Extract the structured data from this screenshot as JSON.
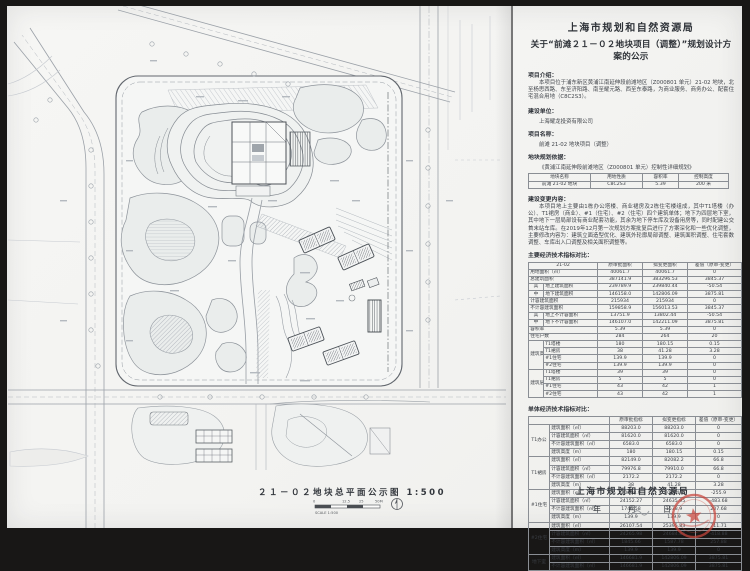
{
  "header": {
    "title1": "上海市规划和自然资源局",
    "title2": "关于“前滩２１－０２地块项目（调整）”规划设计方案的公示"
  },
  "sections": {
    "intro_label": "项目介绍：",
    "intro_text": "本项目位于浦东新区黄浦江南延伸段前滩地区（Z000801 单元）21-02 地块，北至杨思西路、东至济阳路、南至耀元路、西至东泰路，为商业服务、商务办公、配套住宅混合用地（C8C2S3）。",
    "builder_label": "建设单位：",
    "builder_text": "上海耀龙投资有限公司",
    "project_label": "项目名称：",
    "project_text": "前滩 21-02 地块项目（调整）",
    "basis_label": "地块规划依据：",
    "basis_text": "《黄浦江南延伸段前滩地区（Z000801 单元）控制性详细规划》",
    "changes_label": "建设变更内容：",
    "changes_text": "本项目地上主要由1栋办公塔楼、商业裙房及2栋住宅楼组成，其中T1塔楼（办公）、T1裙房（商业）、#1（住宅）、#2（住宅）四个建筑单体；地下为四层地下室，其中地下一层局部设有商业配套功能，其余为地下停车库及设备用房等，同时配建公交首末站车库。在2019年12月第一次规划方案批复后进行了方案深化和一些优化调整，主要修改内容为：建筑立面造型优化、建筑外轮廓局部调整、建筑面积调整、住宅套数调整、车库出入口调整及相关面积调整等。",
    "main_table_label": "主要经济技术指标对比：",
    "unit_table_label": "单体经济技术指标对比："
  },
  "plot_table": {
    "rows": [
      [
        {
          "t": "地块名称",
          "th": 1
        },
        {
          "t": "用地性质",
          "th": 1
        },
        {
          "t": "容积率",
          "th": 1
        },
        {
          "t": "控制高度",
          "th": 1
        }
      ],
      [
        {
          "t": "前滩 21-02 地块"
        },
        {
          "t": "C8C2S3"
        },
        {
          "t": "5.39"
        },
        {
          "t": "200 米"
        }
      ]
    ]
  },
  "main_table": {
    "rows": [
      [
        {
          "t": "21-02",
          "cs": 2,
          "th": 1
        },
        {
          "t": "原审批面积",
          "th": 1
        },
        {
          "t": "拟变更面积",
          "th": 1
        },
        {
          "t": "差值（原审-变更）",
          "th": 1
        }
      ],
      [
        {
          "t": "用地面积（㎡）",
          "cs": 2,
          "l": 1
        },
        {
          "t": "40061.7"
        },
        {
          "t": "40061.7"
        },
        {
          "t": "0"
        }
      ],
      [
        {
          "t": "总建筑面积",
          "cs": 2,
          "l": 1
        },
        {
          "t": "387141.9"
        },
        {
          "t": "383296.53"
        },
        {
          "t": "3845.37"
        }
      ],
      [
        {
          "t": "其"
        },
        {
          "t": "地上建筑面积",
          "l": 1
        },
        {
          "t": "239789.9"
        },
        {
          "t": "239840.44"
        },
        {
          "t": "-50.54"
        }
      ],
      [
        {
          "t": "中"
        },
        {
          "t": "地下建筑面积",
          "l": 1
        },
        {
          "t": "146158.0"
        },
        {
          "t": "142806.09"
        },
        {
          "t": "3875.81"
        }
      ],
      [
        {
          "t": "计容建筑面积",
          "cs": 2,
          "l": 1
        },
        {
          "t": "215934"
        },
        {
          "t": "215934"
        },
        {
          "t": "0"
        }
      ],
      [
        {
          "t": "不计容建筑面积",
          "cs": 2,
          "l": 1
        },
        {
          "t": "159858.9"
        },
        {
          "t": "156013.53"
        },
        {
          "t": "3845.37"
        }
      ],
      [
        {
          "t": "其"
        },
        {
          "t": "地上不计容面积",
          "l": 1
        },
        {
          "t": "13751.9"
        },
        {
          "t": "13802.44"
        },
        {
          "t": "-50.54"
        }
      ],
      [
        {
          "t": "中"
        },
        {
          "t": "地下不计容面积",
          "l": 1
        },
        {
          "t": "146107.0"
        },
        {
          "t": "142211.09"
        },
        {
          "t": "3875.81"
        }
      ],
      [
        {
          "t": "容积率",
          "cs": 2,
          "l": 1
        },
        {
          "t": "5.39"
        },
        {
          "t": "5.39"
        },
        {
          "t": "0"
        }
      ],
      [
        {
          "t": "住宅户数",
          "cs": 2,
          "l": 1
        },
        {
          "t": "284"
        },
        {
          "t": "264"
        },
        {
          "t": "20"
        }
      ],
      [
        {
          "t": "建筑高度",
          "rs": 4
        },
        {
          "t": "T1塔楼",
          "l": 1
        },
        {
          "t": "180"
        },
        {
          "t": "180.15"
        },
        {
          "t": "0.15"
        }
      ],
      [
        {
          "t": "T1裙房",
          "l": 1
        },
        {
          "t": "38"
        },
        {
          "t": "41.28"
        },
        {
          "t": "3.28"
        }
      ],
      [
        {
          "t": "#1住宅",
          "l": 1
        },
        {
          "t": "139.9"
        },
        {
          "t": "139.9"
        },
        {
          "t": "0"
        }
      ],
      [
        {
          "t": "#2住宅",
          "l": 1
        },
        {
          "t": "139.9"
        },
        {
          "t": "139.9"
        },
        {
          "t": "0"
        }
      ],
      [
        {
          "t": "建筑层数",
          "rs": 4
        },
        {
          "t": "T1塔楼",
          "l": 1
        },
        {
          "t": "39"
        },
        {
          "t": "39"
        },
        {
          "t": "0"
        }
      ],
      [
        {
          "t": "T1裙房",
          "l": 1
        },
        {
          "t": "5"
        },
        {
          "t": "5"
        },
        {
          "t": "0"
        }
      ],
      [
        {
          "t": "#1住宅",
          "l": 1
        },
        {
          "t": "43"
        },
        {
          "t": "42"
        },
        {
          "t": "1"
        }
      ],
      [
        {
          "t": "#2住宅",
          "l": 1
        },
        {
          "t": "43"
        },
        {
          "t": "42"
        },
        {
          "t": "1"
        }
      ]
    ]
  },
  "unit_table": {
    "rows": [
      [
        {
          "t": "",
          "cs": 2,
          "th": 1
        },
        {
          "t": "原审批指标",
          "th": 1
        },
        {
          "t": "拟变更指标",
          "th": 1
        },
        {
          "t": "差值（原审-变更）",
          "th": 1
        }
      ],
      [
        {
          "t": "T1办公",
          "rs": 4
        },
        {
          "t": "建筑面积（㎡）",
          "l": 1
        },
        {
          "t": "88203.0"
        },
        {
          "t": "88203.0"
        },
        {
          "t": "0"
        }
      ],
      [
        {
          "t": "计容建筑面积（㎡）",
          "l": 1
        },
        {
          "t": "81620.0"
        },
        {
          "t": "81620.0"
        },
        {
          "t": "0"
        }
      ],
      [
        {
          "t": "不计容建筑面积（㎡）",
          "l": 1
        },
        {
          "t": "6583.0"
        },
        {
          "t": "6583.0"
        },
        {
          "t": "0"
        }
      ],
      [
        {
          "t": "建筑高度（m）",
          "l": 1
        },
        {
          "t": "180"
        },
        {
          "t": "180.15"
        },
        {
          "t": "0.15"
        }
      ],
      [
        {
          "t": "T1裙房",
          "rs": 4
        },
        {
          "t": "建筑面积（㎡）",
          "l": 1
        },
        {
          "t": "82149.0"
        },
        {
          "t": "82082.2"
        },
        {
          "t": "66.8"
        }
      ],
      [
        {
          "t": "计容建筑面积（㎡）",
          "l": 1
        },
        {
          "t": "79976.8"
        },
        {
          "t": "79910.0"
        },
        {
          "t": "66.8"
        }
      ],
      [
        {
          "t": "不计容建筑面积（㎡）",
          "l": 1
        },
        {
          "t": "2172.2"
        },
        {
          "t": "2172.2"
        },
        {
          "t": "0"
        }
      ],
      [
        {
          "t": "建筑高度（m）",
          "l": 1
        },
        {
          "t": "38"
        },
        {
          "t": "41.28"
        },
        {
          "t": "3.28"
        }
      ],
      [
        {
          "t": "#1住宅",
          "rs": 4
        },
        {
          "t": "建筑面积（㎡）",
          "l": 1
        },
        {
          "t": "30008.9"
        },
        {
          "t": "30264.8"
        },
        {
          "t": "-255.9"
        }
      ],
      [
        {
          "t": "计容建筑面积（㎡）",
          "l": 1
        },
        {
          "t": "24152.27"
        },
        {
          "t": "24635.95"
        },
        {
          "t": "-483.68"
        }
      ],
      [
        {
          "t": "不计容建筑面积（㎡）",
          "l": 1
        },
        {
          "t": "1746.58"
        },
        {
          "t": "1538.9"
        },
        {
          "t": "207.68"
        }
      ],
      [
        {
          "t": "建筑高度（m）",
          "l": 1
        },
        {
          "t": "139.9"
        },
        {
          "t": "139.9"
        },
        {
          "t": "0"
        }
      ],
      [
        {
          "t": "#2住宅",
          "rs": 4
        },
        {
          "t": "建筑面积（㎡）",
          "l": 1
        },
        {
          "t": "26107.54"
        },
        {
          "t": "25395.83"
        },
        {
          "t": "711.71"
        }
      ],
      [
        {
          "t": "计容建筑面积（㎡）",
          "l": 1
        },
        {
          "t": "24265.98"
        },
        {
          "t": "24684.86"
        },
        {
          "t": "-418.88"
        }
      ],
      [
        {
          "t": "不计容建筑面积（㎡）",
          "l": 1
        },
        {
          "t": "1845.66"
        },
        {
          "t": "1587.78"
        },
        {
          "t": "257.88"
        }
      ],
      [
        {
          "t": "建筑高度（m）",
          "l": 1
        },
        {
          "t": "139.9"
        },
        {
          "t": "139.9"
        },
        {
          "t": "0"
        }
      ],
      [
        {
          "t": "地下室",
          "rs": 2
        },
        {
          "t": "建筑面积（㎡）",
          "l": 1
        },
        {
          "t": "146681.9"
        },
        {
          "t": "142806.09"
        },
        {
          "t": "3875.81"
        }
      ],
      [
        {
          "t": "不计容建筑面积（㎡）",
          "l": 1
        },
        {
          "t": "146681.9"
        },
        {
          "t": "142806.09"
        },
        {
          "t": "3875.81"
        }
      ]
    ]
  },
  "plan": {
    "caption": "２１－０２地块总平面公示图  1:500",
    "scale": {
      "t0": "0",
      "t1": "12.5",
      "t2": "25",
      "t3": "50M",
      "label": "SCALE 1:500"
    }
  },
  "footer": {
    "org": "上海市规划和自然资源局",
    "date_y": "年",
    "date_m": "月",
    "date_d": "日"
  },
  "colors": {
    "seal_red": "#c9453c",
    "drawing_line": "#7d838b",
    "paper": "#f4f4f2"
  }
}
